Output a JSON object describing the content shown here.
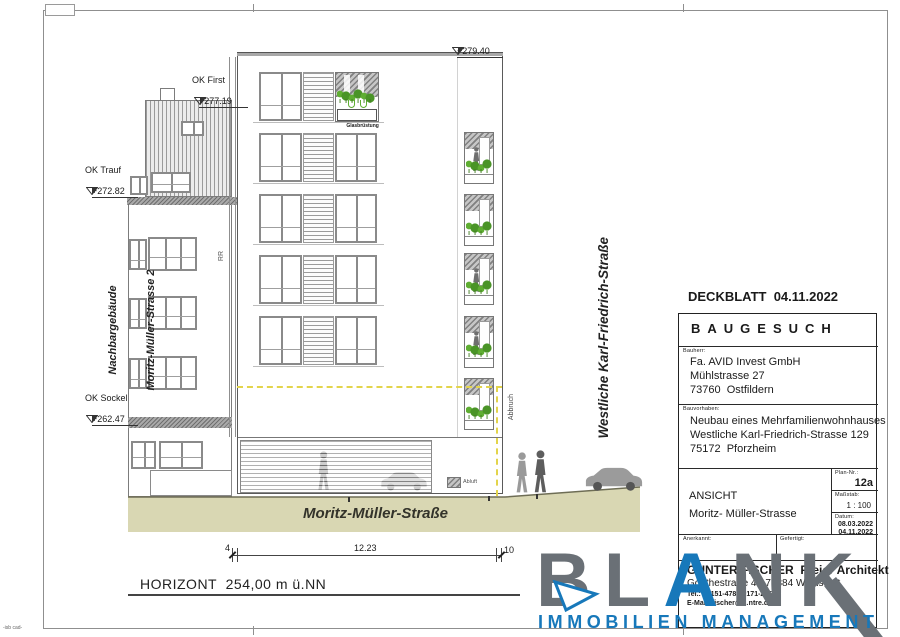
{
  "drawing": {
    "levels": {
      "top_value": "+279.40",
      "ok_first_label": "OK First",
      "ok_first_value": "+277.19",
      "ok_trauf_label": "OK Trauf",
      "ok_trauf_value": "+272.82",
      "ok_sockel_label": "OK Sockel",
      "ok_sockel_value": "+262.47"
    },
    "labels": {
      "neighbor_line1": "Nachbargebäude",
      "neighbor_line2": "Moritz-Müller-Strasse 2",
      "rr": "RR",
      "abbruch": "Abbruch",
      "abluft": "Abluft",
      "glass_railing": "Glasbrüstung",
      "street_right": "Westliche Karl-Friedrich-Straße",
      "street_bottom": "Moritz-Müller-Straße",
      "horizon": "HORIZONT  254,00 m ü.NN",
      "corner_note": "-isb cad-"
    },
    "dimensions": {
      "left": "4",
      "middle": "12.23",
      "right": "10"
    }
  },
  "titleblock": {
    "header": "DECKBLATT  04.11.2022",
    "doc_type": "BAUGESUCH",
    "bauherr_label": "Bauherr:",
    "bauherr": [
      "Fa. AVID Invest GmbH",
      "Mühlstrasse 27",
      "73760  Ostfildern"
    ],
    "bauvorhaben_label": "Bauvorhaben:",
    "bauvorhaben": [
      "Neubau eines Mehrfamilienwohnhauses",
      "Westliche Karl-Friedrich-Strasse 129",
      "75172  Pforzheim"
    ],
    "plan_label": "Plan-Nr.:",
    "plan_nr": "12a",
    "massstab_label": "Maßstab:",
    "massstab": "1 : 100",
    "datum_label": "Datum:",
    "datum1": "08.03.2022",
    "datum2": "04.11.2022",
    "view_label": "ANSICHT",
    "view_name": "Moritz- Müller-Strasse",
    "anerkannt_label": "Anerkannt:",
    "gefertigt_label": "Gefertigt:",
    "architect": [
      "GUNTER FISCHER  Freier Architekt",
      "Goethestraße 4 · 71384 Weinstadt",
      "Tel.: 07151-478 · 0171-215",
      "E-Mail: fischer@…ntre.de"
    ]
  },
  "logo": {
    "word_b": "BL",
    "word_a": "A",
    "word_k": "NK",
    "subtitle": "IMMOBILIEN MANAGEMENT",
    "gray": "#6a7076",
    "blue": "#1778ba"
  },
  "colors": {
    "ground": "#d9d7b3",
    "demolition_line": "#e3d44b",
    "greenery": "#5fae32"
  }
}
